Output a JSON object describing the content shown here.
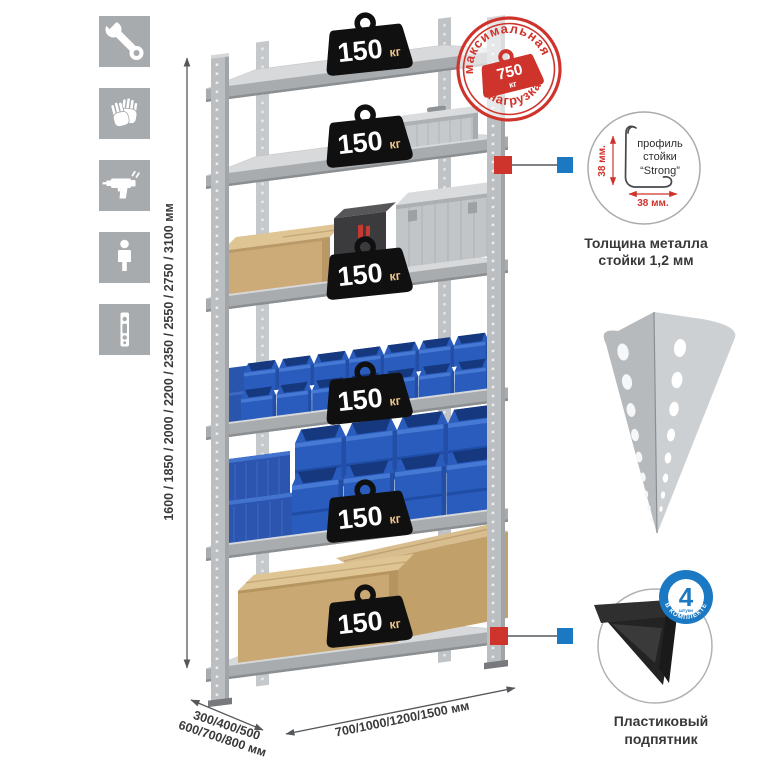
{
  "page": {
    "background": "#ffffff"
  },
  "sidebar": {
    "icons": [
      {
        "name": "wrench-icon"
      },
      {
        "name": "gloves-icon"
      },
      {
        "name": "drill-icon"
      },
      {
        "name": "person-icon"
      },
      {
        "name": "perforated-strip-icon"
      }
    ]
  },
  "rack": {
    "shelves": [
      {
        "capacity": "150",
        "unit": "кг"
      },
      {
        "capacity": "150",
        "unit": "кг"
      },
      {
        "capacity": "150",
        "unit": "кг"
      },
      {
        "capacity": "150",
        "unit": "кг"
      },
      {
        "capacity": "150",
        "unit": "кг"
      },
      {
        "capacity": "150",
        "unit": "кг"
      }
    ],
    "dimensions": {
      "height": "1600 / 1850 / 2000 / 2200 / 2350 / 2550 / 2750 / 3100 мм",
      "depth_line1": "300/400/500",
      "depth_line2": "600/700/800 мм",
      "width": "700/1000/1200/1500 мм"
    }
  },
  "max_load_stamp": {
    "text_top": "максимальная",
    "text_bottom": "нагрузка",
    "value": "750",
    "unit": "кг"
  },
  "profile_detail": {
    "label_line1": "профиль",
    "label_line2": "стойки",
    "label_line3": "“Strong”",
    "dim_vertical": "38 мм.",
    "dim_horizontal": "38 мм.",
    "caption_line1": "Толщина металла",
    "caption_line2": "стойки 1,2 мм"
  },
  "foot_detail": {
    "badge_count": "4",
    "badge_small_text": "штуки",
    "badge_ring_text": "в комплекте",
    "caption_line1": "Пластиковый",
    "caption_line2": "подпятник"
  },
  "colors": {
    "accent_red": "#cf342c",
    "accent_blue": "#1b78c2",
    "weight_black": "#101010",
    "bin_blue": "#2a5cbd",
    "cardboard": "#c9a873",
    "metal_gray": "#c0c3c6"
  }
}
